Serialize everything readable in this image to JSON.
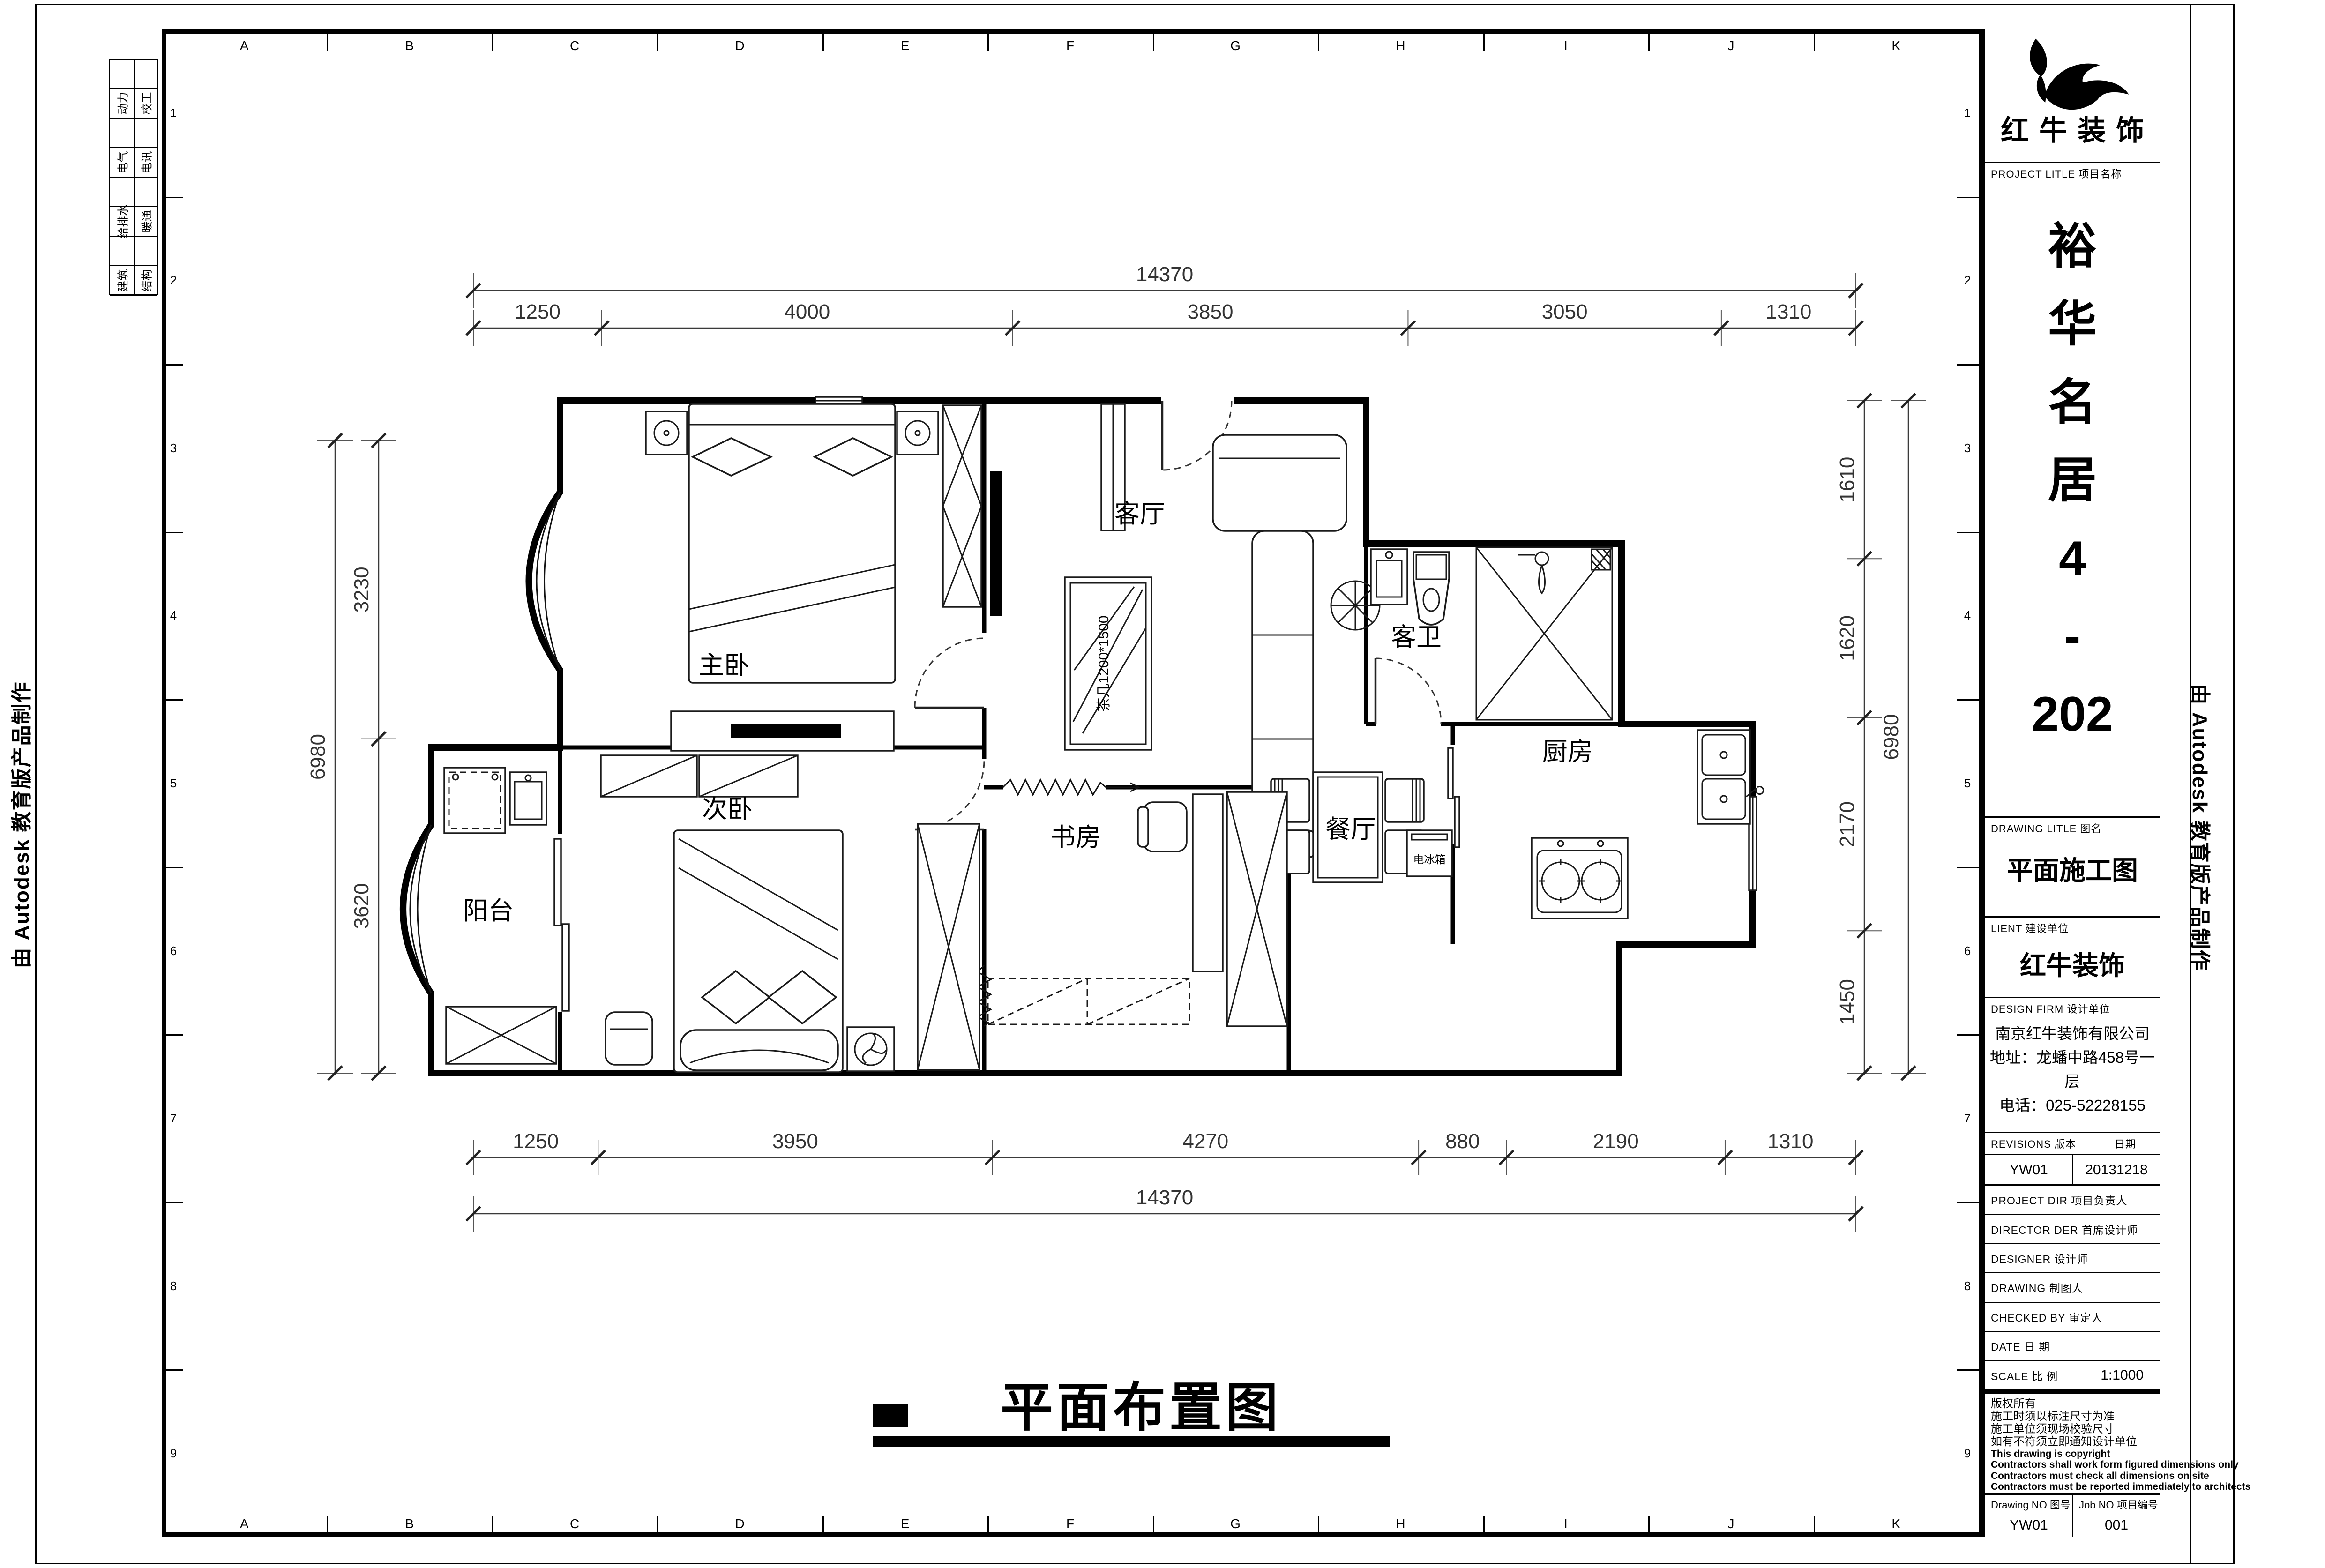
{
  "sheet": {
    "background": "#ffffff",
    "line_color": "#000000"
  },
  "margins": {
    "attribution_left": "由 Autodesk 教育版产品制作",
    "attribution_right": "由 Autodesk 教育版产品制作",
    "disciplines": [
      {
        "col1": "动力",
        "col2": "校工"
      },
      {
        "col1": "电气",
        "col2": "电讯"
      },
      {
        "col1": "给排水",
        "col2": "暖通"
      },
      {
        "col1": "建筑",
        "col2": "结构"
      }
    ]
  },
  "grid": {
    "letters": [
      "A",
      "B",
      "C",
      "D",
      "E",
      "F",
      "G",
      "H",
      "I",
      "J",
      "K"
    ],
    "numbers": [
      "1",
      "2",
      "3",
      "4",
      "5",
      "6",
      "7",
      "8",
      "9"
    ]
  },
  "title_block": {
    "company": "红牛装饰",
    "project_label": "PROJECT LITLE 项目名称",
    "project_name_lines": [
      "裕",
      "华",
      "名",
      "居",
      "4",
      "-",
      "202"
    ],
    "drawing_title_label": "DRAWING LITLE 图名",
    "drawing_title": "平面施工图",
    "client_label": "LIENT 建设单位",
    "client": "红牛装饰",
    "design_firm_label": "DESIGN FIRM 设计单位",
    "design_firm_lines": [
      "南京红牛装饰有限公司",
      "地址：龙蟠中路458号一层",
      "电话：025-52228155"
    ],
    "revisions_label": "REVISIONS 版本",
    "revisions_date_label": "日期",
    "revision_no": "YW01",
    "revision_date": "20131218",
    "info_rows": [
      {
        "label": "PROJECT DIR 项目负责人",
        "value": ""
      },
      {
        "label": "DIRECTOR DER 首席设计师",
        "value": ""
      },
      {
        "label": "DESIGNER 设计师",
        "value": ""
      },
      {
        "label": "DRAWING 制图人",
        "value": ""
      },
      {
        "label": "CHECKED BY 审定人",
        "value": ""
      },
      {
        "label": "DATE 日 期",
        "value": ""
      },
      {
        "label": "SCALE 比 例",
        "value": "1:1000"
      }
    ],
    "copyright_lines": [
      "版权所有",
      "施工时须以标注尺寸为准",
      "施工单位须现场校验尺寸",
      "如有不符须立即通知设计单位",
      "This drawing is copyright",
      "Contractors shall work form figured dimensions only",
      "Contractors must check all dimensions on site",
      "Contractors must be reported immediately to architects"
    ],
    "drawing_no_label": "Drawing NO 图号",
    "drawing_no": "YW01",
    "job_no_label": "Job NO 项目编号",
    "job_no": "001"
  },
  "plan": {
    "title": "平面布置图",
    "rooms": [
      {
        "id": "master-bedroom",
        "label": "主卧"
      },
      {
        "id": "second-bedroom",
        "label": "次卧"
      },
      {
        "id": "living-room",
        "label": "客厅"
      },
      {
        "id": "guest-bathroom",
        "label": "客卫"
      },
      {
        "id": "study",
        "label": "书房"
      },
      {
        "id": "dining-room",
        "label": "餐厅"
      },
      {
        "id": "kitchen",
        "label": "厨房"
      },
      {
        "id": "balcony",
        "label": "阳台"
      }
    ],
    "furniture_labels": [
      {
        "id": "coffee-table",
        "label": "茶几1200*1500"
      },
      {
        "id": "fridge",
        "label": "电冰箱"
      }
    ],
    "dimensions": {
      "top": {
        "segments": [
          "1250",
          "4000",
          "3850",
          "3050",
          "1310"
        ],
        "total": "14370"
      },
      "bottom": {
        "segments": [
          "1250",
          "3950",
          "4270",
          "880",
          "2190",
          "1310"
        ],
        "total": "14370"
      },
      "left": {
        "segments": [
          "3230",
          "3620"
        ],
        "total": "6980"
      },
      "right": {
        "segments": [
          "1610",
          "1620",
          "2170",
          "1450"
        ],
        "total": "6980"
      }
    }
  }
}
